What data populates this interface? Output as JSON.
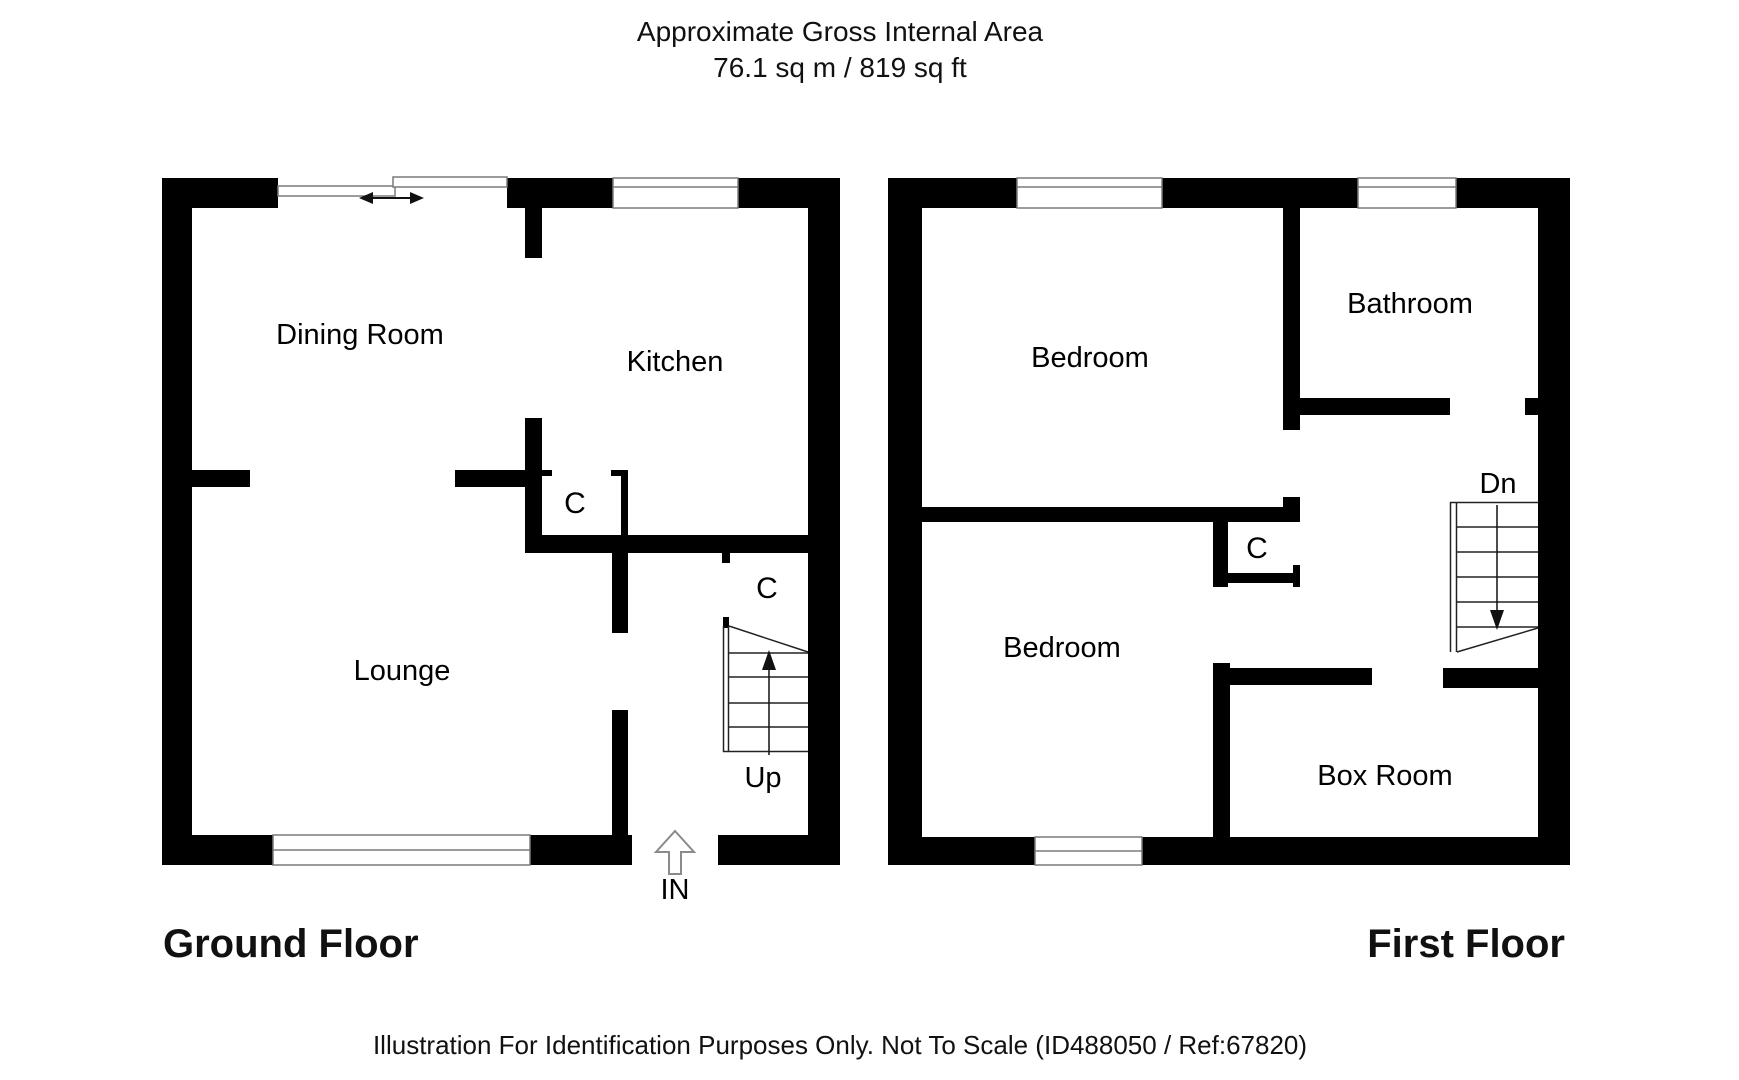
{
  "title": {
    "line1": "Approximate Gross Internal Area",
    "line2": "76.1 sq m / 819 sq ft"
  },
  "ground_floor": {
    "name": "Ground Floor",
    "rooms": {
      "dining": "Dining Room",
      "kitchen": "Kitchen",
      "lounge": "Lounge",
      "closet_kitchen": "C",
      "closet_understairs": "C"
    },
    "stairs_label": "Up",
    "entrance_label": "IN"
  },
  "first_floor": {
    "name": "First Floor",
    "rooms": {
      "bedroom_front": "Bedroom",
      "bathroom": "Bathroom",
      "bedroom_back": "Bedroom",
      "closet": "C",
      "box_room": "Box Room"
    },
    "stairs_label": "Dn"
  },
  "footer": {
    "disclaimer": "Illustration For Identification Purposes Only. Not To Scale (ID488050 / Ref:67820)"
  },
  "colors": {
    "wall-color": "#000000",
    "window-line": "#7a7a7a"
  }
}
